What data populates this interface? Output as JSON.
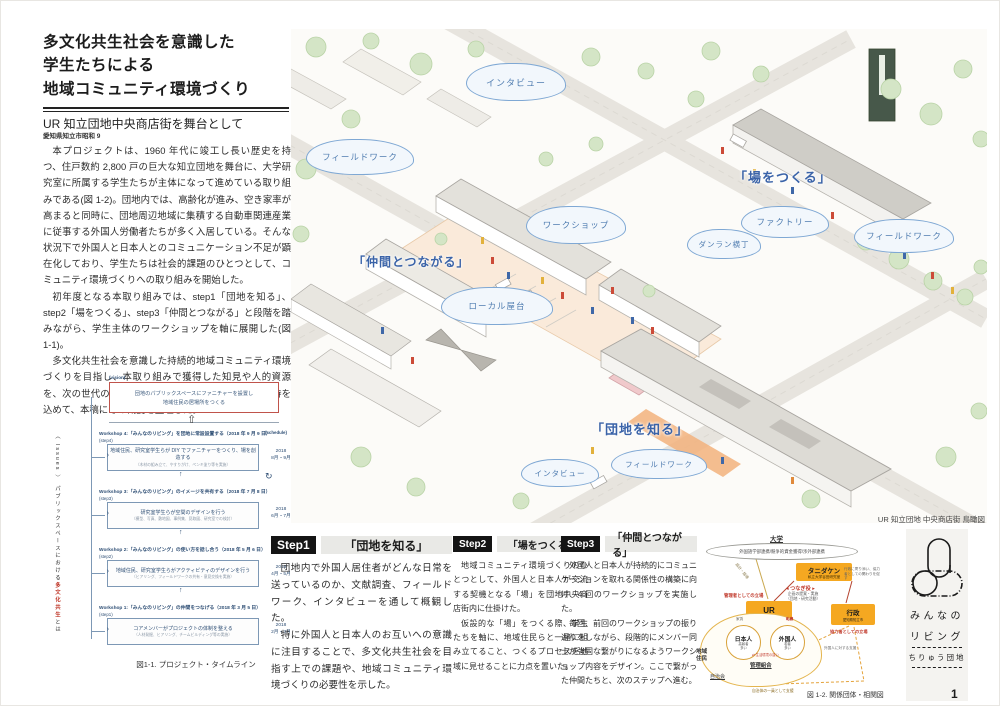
{
  "header": {
    "title_line1": "多文化共生社会を意識した",
    "title_line2": "学生たちによる",
    "title_line3": "地域コミュニティ環境づくり",
    "subtitle": "UR 知立団地中央商店街を舞台として",
    "location": "愛知県知立市昭和 9"
  },
  "intro": {
    "p1": "本プロジェクトは、1960 年代に竣工し長い歴史を持つ、住戸数約 2,800 戸の巨大な知立団地を舞台に、大学研究室に所属する学生たちが主体になって進めている取り組みである(図 1-2)。団地内では、高齢化が進み、空き家率が高まると同時に、団地周辺地域に集積する自動車関連産業に従事する外国人労働者たちが多く入居している。そんな状況下で外国人と日本人とのコミュニケーション不足が顕在化しており、学生たちは社会的課題のひとつとして、コミュニティ環境づくりへの取り組みを開始した。",
    "p2": "初年度となる本取り組みでは、step1「団地を知る」、step2「場をつくる」、step3「仲間とつながる」と段階を踏みながら、学生主体のワークショップを軸に展開した(図 1-1)。",
    "p3": "多文化共生社会を意識した持続的地域コミュニティ環境づくりを目指し、本取り組みで獲得した知見や人的資源を、次の世代の学生たちに渡し、さらなる展開への期待を込めて、本稿にその概要を整理した。"
  },
  "timeline": {
    "vision_label": "(vision)",
    "goal_line1": "団地のパブリックスペースにファニチャーを設置し",
    "goal_line2": "地域住民の居場所をつくる",
    "schedule_label": "(schedule)",
    "issues_bracket": "〈 Issues 〉",
    "issues_text": "パブリックスペースにおける",
    "issues_red": "多文化共生",
    "issues_tail": "とは",
    "workshops": [
      {
        "heading": "Workshop 4:「みんなのリビング」を団地に常設設置する（2018 年 9 月 9 日）",
        "step_label": "(step4)",
        "main": "地域住民、研究室学生らが DIY でファニチャーをつくり、場を創造する",
        "sub": "（木材の組み立て、やすりがけ、ペンキ塗り等を実施）",
        "period": "2018\n8月・9月"
      },
      {
        "heading": "Workshop 3:「みんなのリビング」のイメージを共有する（2018 年 7 月 8 日）",
        "step_label": "(step3)",
        "main": "研究室学生らが空間のデザインを行う",
        "sub": "（模型、写真、敷地図、事例集、見取図、研究室での検討）",
        "period": "2018\n6月・7月"
      },
      {
        "heading": "Workshop 2:「みんなのリビング」の使い方を話し合う（2018 年 5 月 6 日）",
        "step_label": "(step2)",
        "main": "地域住民、研究室学生らがアクティビティのデザインを行う",
        "sub": "（ヒアリング、フィールドワークの共有・意見交換を実施）",
        "period": "2018\n4月・5月"
      },
      {
        "heading": "Workshop 1:「みんなのリビング」の仲間をつなげる（2018 年 3 月 5 日）",
        "step_label": "(step1)",
        "main": "コアメンバーがプロジェクトの体制を整える",
        "sub": "（人材発掘、ヒアリング、チームビルディング等の実施）",
        "period": "2018\n2月・3月"
      }
    ],
    "caption": "図1-1. プロジェクト・タイムライン"
  },
  "illustration": {
    "clouds": [
      "インタビュー",
      "フィールドワーク",
      "ワークショップ",
      "ファクトリー",
      "ダンラン横丁",
      "フィールドワーク",
      "ローカル屋台",
      "インタビュー",
      "フィールドワーク"
    ],
    "label_tsukuru": "「場をつくる」",
    "label_nakama": "「仲間とつながる」",
    "label_shiru": "「団地を知る」",
    "caption": "UR 知立団地  中央商店街  鳥瞰図"
  },
  "steps": [
    {
      "badge": "Step1",
      "title": "「団地を知る」",
      "p1": "団地内で外国人居住者がどんな日常を送っているのか、文献調査、フィールドワーク、インタビューを通して概観した。",
      "p2": "特に外国人と日本人のお互いへの意識に注目することで、多文化共生社会を目指す上での課題や、地域コミュニティ環境づくりの必要性を示した。"
    },
    {
      "badge": "Step2",
      "title": "「場をつくる」",
      "p1": "地域コミュニティ環境づくりのひとつとして、外国人と日本人が交流する契機となる「場」を団地中央商店街内に仕掛けた。",
      "p2": "仮設的な「場」をつくる際、学生たちを軸に、地域住民らと一緒に組み立てること、つくるプロセスを地域に見せることに力点を置いた。"
    },
    {
      "badge": "Step3",
      "title": "「仲間とつながる」",
      "p1": "外国人と日本人が持続的にコミュニケーションを取れる関係性の構築に向け、4 回のワークショップを実施した。",
      "p2": "毎回、前回のワークショップの振り返りをしながら、段階的にメンバー同士が強固な繋がりになるようワークショップ内容をデザイン。ここで繋がった仲間たちと、次のステップへ進む。"
    }
  ],
  "diagram": {
    "university_name": "大学",
    "university_detail": "外国語学部連携/競争的資金獲得/渉外部連携",
    "lab_name": "タニダケン",
    "lab_detail": "私立大学谷田研究室",
    "connector_role": "◂ つなぎ役 ▸",
    "connector_detail": "企画の提案・実施\n（団地・研究活動）",
    "design_note": "設計・指導",
    "gov_note": "行政に寄り添い、協力者としての関わりを促す",
    "left_role": "管理者としての立場",
    "right_role": "協力者としての立場",
    "ur_name": "UR",
    "ur_detail": "知立団地",
    "gov_name": "行政",
    "gov_detail": "愛知県知立市",
    "residents_label": "地域\n住民",
    "jichikai": "自治会",
    "kanri": "管理組合",
    "japanese_name": "日本人",
    "japanese_detail": "高齢者\n多い",
    "foreign_name": "外国人",
    "foreign_detail": "若者\n多い",
    "between": "⇄ 生活環境の違い",
    "rent": "家賃",
    "friction": "軋轢",
    "support_right": "外国人に対する支援",
    "support_bottom": "自治体の一員として支援",
    "caption": "図 1-2. 関係団体・相関図"
  },
  "logo": {
    "line1": "みんなの",
    "line2": "リビング",
    "line3": "ちりゅう団地"
  },
  "page_number": "1"
}
